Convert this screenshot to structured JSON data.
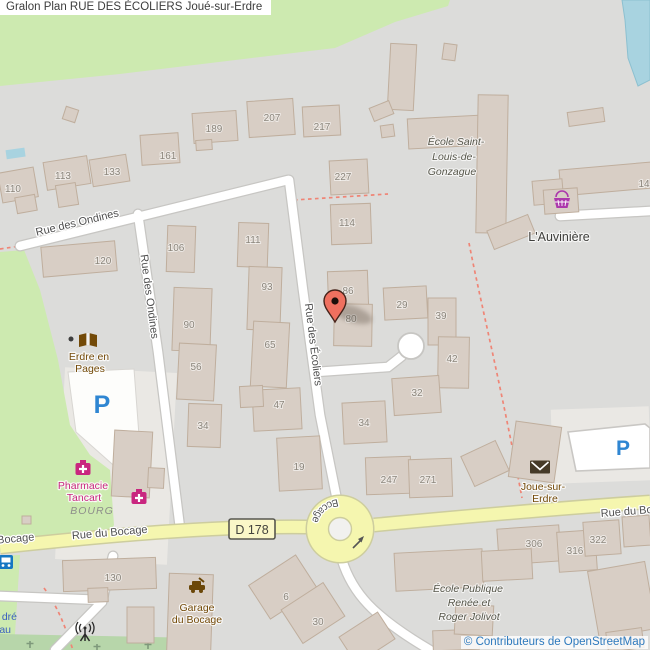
{
  "header": {
    "title": "Gralon Plan RUE DES ÉCOLIERS Joué-sur-Erdre"
  },
  "footer": {
    "attribution": "© Contributeurs de OpenStreetMap"
  },
  "map": {
    "streets": {
      "ondines": "Rue des Ondines",
      "ecoliers": "Rue des Écoliers",
      "bocage": "Rue du Bocage",
      "bocage_partial": "Bocage"
    },
    "shield": {
      "label": "D 178"
    },
    "places": {
      "auviniere": "L'Auvinière",
      "bourg": "BOURG"
    },
    "schools": {
      "slg": {
        "line1": "École Saint-",
        "line2": "Louis-de-",
        "line3": "Gonzague"
      },
      "public": {
        "line1": "École Publique",
        "line2": "Renée et",
        "line3": "Roger Jolivot"
      }
    },
    "pois": {
      "library": {
        "line1": "Erdre en",
        "line2": "Pages"
      },
      "pharmacy": {
        "line1": "Pharmacie",
        "line2": "Tancart"
      },
      "garage": {
        "line1": "Garage",
        "line2": "du Bocage"
      },
      "post": {
        "line1": "Joue-sur-",
        "line2": "Erdre"
      }
    },
    "parking": {
      "letter": "P"
    },
    "partial_labels": {
      "dre": "dré",
      "au": "au"
    },
    "marker": {
      "street": "Rue des Écoliers",
      "x": 335,
      "y": 301
    },
    "colors": {
      "land": "#dcdcda",
      "green": "#cdeab0",
      "cemetery": "#b7d6aa",
      "water": "#a8d3e0",
      "building": "#d8cec5",
      "building_stroke": "#bfae9d",
      "road_white": "#ffffff",
      "road_casing": "#c7c6c3",
      "road_yellow": "#f5f6af",
      "yellow_casing": "#cdcd9e",
      "path_dashed": "#ef8576",
      "marker_fill": "#ef705f",
      "pharmacy": "#c9267f",
      "shop": "#ac39ac",
      "poi_brown": "#734a08",
      "blue_p": "#2f86d2"
    },
    "house_numbers": [
      [
        "189",
        214,
        132
      ],
      [
        "207",
        272,
        121
      ],
      [
        "217",
        322,
        130
      ],
      [
        "161",
        168,
        159
      ],
      [
        "113",
        63,
        179
      ],
      [
        "133",
        112,
        175
      ],
      [
        "110",
        13,
        192
      ],
      [
        "227",
        343,
        180
      ],
      [
        "114",
        347,
        226
      ],
      [
        "106",
        176,
        251
      ],
      [
        "111",
        253,
        243
      ],
      [
        "120",
        103,
        264
      ],
      [
        "93",
        267,
        290
      ],
      [
        "86",
        348,
        294
      ],
      [
        "80",
        351,
        322
      ],
      [
        "29",
        402,
        308
      ],
      [
        "39",
        441,
        319
      ],
      [
        "90",
        189,
        328
      ],
      [
        "65",
        270,
        348
      ],
      [
        "56",
        196,
        370
      ],
      [
        "42",
        452,
        362
      ],
      [
        "32",
        417,
        396
      ],
      [
        "47",
        279,
        408
      ],
      [
        "34",
        203,
        429
      ],
      [
        "34",
        364,
        426
      ],
      [
        "19",
        299,
        470
      ],
      [
        "247",
        389,
        483
      ],
      [
        "271",
        428,
        483
      ],
      [
        "130",
        113,
        581
      ],
      [
        "306",
        534,
        547
      ],
      [
        "316",
        575,
        554
      ],
      [
        "322",
        598,
        543
      ],
      [
        "6",
        286,
        600
      ],
      [
        "30",
        318,
        625
      ],
      [
        "14",
        644,
        187
      ]
    ],
    "buildings": [
      [
        64,
        108,
        13,
        13,
        18
      ],
      [
        0,
        170,
        36,
        30,
        -10
      ],
      [
        16,
        196,
        20,
        16,
        -10
      ],
      [
        45,
        159,
        44,
        28,
        -9
      ],
      [
        57,
        184,
        20,
        22,
        -9
      ],
      [
        91,
        157,
        37,
        27,
        -9
      ],
      [
        141,
        134,
        38,
        30,
        -4
      ],
      [
        193,
        112,
        44,
        30,
        -4
      ],
      [
        196,
        140,
        16,
        10,
        -4
      ],
      [
        248,
        100,
        46,
        36,
        -4
      ],
      [
        303,
        106,
        37,
        30,
        -3
      ],
      [
        389,
        44,
        26,
        66,
        3
      ],
      [
        443,
        44,
        13,
        16,
        8
      ],
      [
        371,
        104,
        21,
        14,
        -22
      ],
      [
        381,
        125,
        13,
        12,
        -8
      ],
      [
        330,
        160,
        38,
        34,
        -3
      ],
      [
        408,
        117,
        76,
        30,
        -3
      ],
      [
        477,
        95,
        30,
        138,
        1
      ],
      [
        489,
        222,
        44,
        20,
        -22
      ],
      [
        331,
        204,
        40,
        40,
        -2
      ],
      [
        568,
        110,
        36,
        14,
        -8
      ],
      [
        560,
        166,
        92,
        26,
        -5
      ],
      [
        533,
        180,
        30,
        24,
        -5
      ],
      [
        544,
        189,
        34,
        24,
        -4
      ],
      [
        167,
        226,
        28,
        46,
        2
      ],
      [
        238,
        223,
        30,
        44,
        2
      ],
      [
        42,
        244,
        74,
        30,
        -5
      ],
      [
        248,
        267,
        33,
        63,
        2
      ],
      [
        328,
        271,
        40,
        36,
        -2
      ],
      [
        334,
        304,
        38,
        42,
        1
      ],
      [
        384,
        287,
        43,
        32,
        -3
      ],
      [
        428,
        298,
        28,
        47,
        0
      ],
      [
        173,
        288,
        38,
        63,
        2
      ],
      [
        252,
        322,
        36,
        65,
        3
      ],
      [
        178,
        344,
        37,
        56,
        3
      ],
      [
        438,
        337,
        31,
        51,
        1
      ],
      [
        393,
        377,
        47,
        37,
        -4
      ],
      [
        253,
        389,
        48,
        41,
        -3
      ],
      [
        240,
        386,
        23,
        21,
        -3
      ],
      [
        188,
        404,
        33,
        43,
        2
      ],
      [
        343,
        402,
        43,
        41,
        -3
      ],
      [
        278,
        437,
        43,
        53,
        -3
      ],
      [
        366,
        457,
        45,
        37,
        -2
      ],
      [
        409,
        459,
        43,
        38,
        -2
      ],
      [
        113,
        431,
        38,
        66,
        3
      ],
      [
        148,
        468,
        16,
        20,
        3
      ],
      [
        512,
        424,
        46,
        56,
        8
      ],
      [
        466,
        447,
        38,
        33,
        -25
      ],
      [
        63,
        559,
        93,
        31,
        -2
      ],
      [
        88,
        588,
        20,
        14,
        -2
      ],
      [
        127,
        607,
        27,
        36,
        0
      ],
      [
        168,
        574,
        44,
        78,
        2
      ],
      [
        255,
        567,
        56,
        40,
        -33
      ],
      [
        288,
        593,
        50,
        40,
        -33
      ],
      [
        344,
        622,
        46,
        32,
        -33
      ],
      [
        498,
        527,
        62,
        36,
        -4
      ],
      [
        558,
        531,
        38,
        40,
        -4
      ],
      [
        584,
        521,
        36,
        34,
        -4
      ],
      [
        623,
        516,
        27,
        30,
        -4
      ],
      [
        395,
        551,
        88,
        38,
        -3
      ],
      [
        482,
        550,
        50,
        30,
        -3
      ],
      [
        593,
        566,
        58,
        68,
        -10
      ],
      [
        607,
        630,
        36,
        20,
        -8
      ],
      [
        433,
        630,
        46,
        20,
        -2
      ],
      [
        455,
        605,
        38,
        30,
        3
      ],
      [
        22,
        516,
        9,
        8,
        0
      ]
    ]
  }
}
